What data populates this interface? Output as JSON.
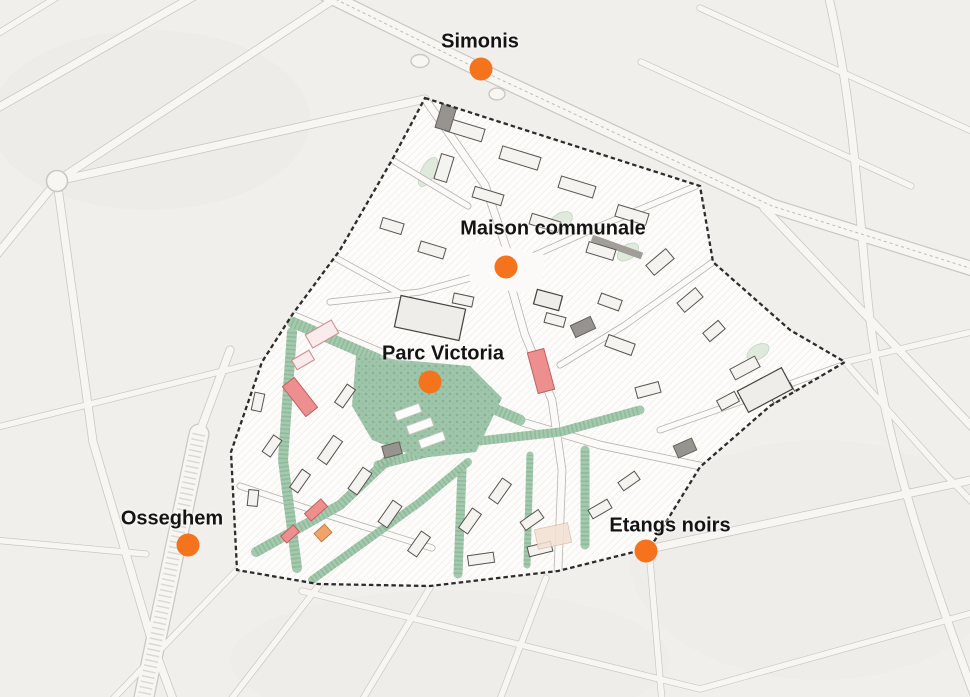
{
  "figure": {
    "type": "urban-plan-map",
    "background_color": "#f1efec",
    "marker_dot_color": "#f5731d",
    "label_text_color": "#141414",
    "study_area": {
      "boundary_color": "#2c2c2c",
      "boundary_style": "dashed",
      "fill_color": "#fdfcfa",
      "park_color": "#9ec5aa",
      "highlight_building_color": "#ee8f8f",
      "secondary_highlight_color": "#f0a46a"
    },
    "markers": [
      {
        "id": "simonis",
        "label": "Simonis"
      },
      {
        "id": "maison-communale",
        "label": "Maison communale"
      },
      {
        "id": "parc-victoria",
        "label": "Parc Victoria"
      },
      {
        "id": "osseghem",
        "label": "Osseghem"
      },
      {
        "id": "etangs-noirs",
        "label": "Etangs noirs"
      }
    ]
  }
}
